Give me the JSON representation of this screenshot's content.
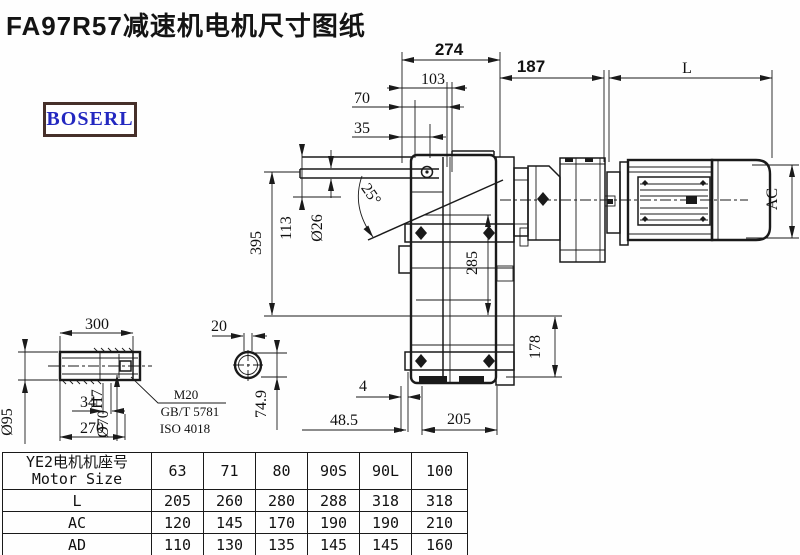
{
  "title": "FA97R57减速机电机尺寸图纸",
  "logo": {
    "text": "BOSERL"
  },
  "colors": {
    "line": "#1a1a1a",
    "logo_border": "#46302a",
    "logo_text": "#2328c0"
  },
  "dims": {
    "d274": "274",
    "d103": "103",
    "d70": "70",
    "d35": "35",
    "d187": "187",
    "dL": "L",
    "dAC": "AC",
    "d395": "395",
    "d113": "113",
    "d26": "Ø26",
    "d25": "25°",
    "d285": "285",
    "d178": "178",
    "d4": "4",
    "d48_5": "48.5",
    "d205": "205",
    "d300": "300",
    "d95": "Ø95",
    "d70v": "Ø70",
    "d70tol": "H7",
    "d34": "34",
    "d270": "270",
    "m20": "M20",
    "gbt": "GB/T 5781",
    "iso": "ISO 4018",
    "d20": "20",
    "d74_9": "74.9"
  },
  "table": {
    "header_cn": "YE2电机机座号",
    "header_en": "Motor Size",
    "columns": [
      "63",
      "71",
      "80",
      "90S",
      "90L",
      "100"
    ],
    "rows": [
      {
        "label": "L",
        "values": [
          "205",
          "260",
          "280",
          "288",
          "318",
          "318"
        ]
      },
      {
        "label": "AC",
        "values": [
          "120",
          "145",
          "170",
          "190",
          "190",
          "210"
        ]
      },
      {
        "label": "AD",
        "values": [
          "110",
          "130",
          "135",
          "145",
          "145",
          "160"
        ]
      }
    ]
  }
}
